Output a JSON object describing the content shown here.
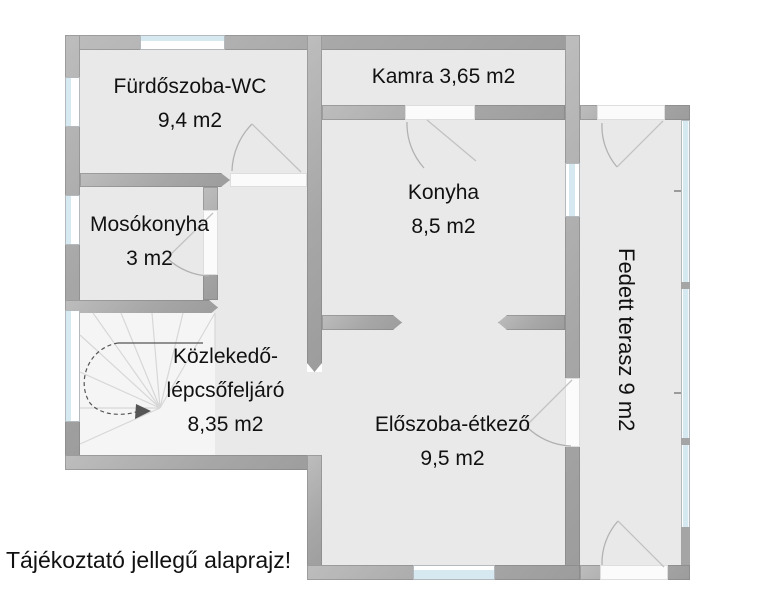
{
  "note": "Tájékoztató jellegű alaprajz!",
  "rooms": {
    "furdoszoba": {
      "name": "Fürdőszoba-WC",
      "area": "9,4 m2"
    },
    "kamra": {
      "label": "Kamra 3,65 m2"
    },
    "konyha": {
      "name": "Konyha",
      "area": "8,5 m2"
    },
    "mosokonyha": {
      "name": "Mosókonyha",
      "area": "3 m2"
    },
    "kozlekedo": {
      "name_line1": "Közlekedő-",
      "name_line2": "lépcsőfeljáró",
      "area": "8,35 m2"
    },
    "eloszoba": {
      "name": "Előszoba-étkező",
      "area": "9,5 m2"
    },
    "terasz": {
      "label": "Fedett terasz 9 m2"
    }
  },
  "colors": {
    "wall": "#a9a9a9",
    "floor": "#e9e9e9",
    "glass": "#d6e8f0",
    "stair": "#f5f5f5",
    "text": "#111111"
  }
}
